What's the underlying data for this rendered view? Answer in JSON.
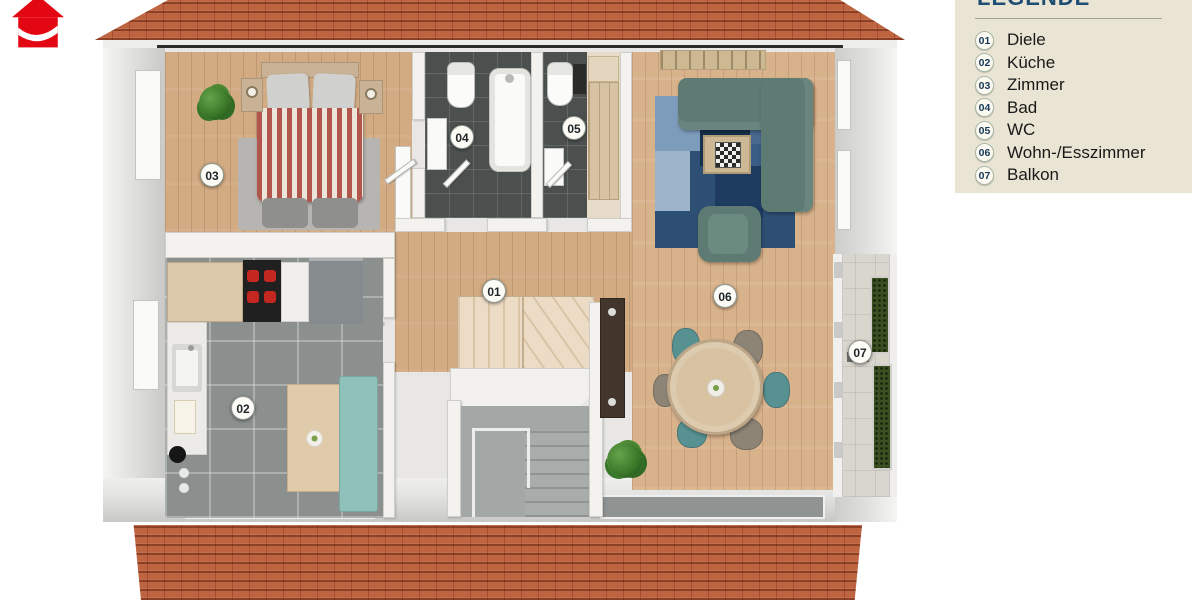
{
  "legend": {
    "title": "LEGENDE",
    "items": [
      {
        "num": "01",
        "label": "Diele"
      },
      {
        "num": "02",
        "label": "Küche"
      },
      {
        "num": "03",
        "label": "Zimmer"
      },
      {
        "num": "04",
        "label": "Bad"
      },
      {
        "num": "05",
        "label": "WC"
      },
      {
        "num": "06",
        "label": "Wohn-/Esszimmer"
      },
      {
        "num": "07",
        "label": "Balkon"
      }
    ]
  },
  "plan": {
    "badges": [
      {
        "num": "01"
      },
      {
        "num": "02"
      },
      {
        "num": "03"
      },
      {
        "num": "04"
      },
      {
        "num": "05"
      },
      {
        "num": "06"
      },
      {
        "num": "07"
      }
    ]
  },
  "icons": {
    "logo": "red-house-logo"
  },
  "colors": {
    "logo_red": "#e30613",
    "roof_tile": "#bf6440",
    "legend_bg": "#e9e4d3",
    "legend_title": "#1e4e74",
    "wood_floor": "#d5ae87",
    "kitchen_tile": "#8b908e",
    "bath_tile": "#4b504f",
    "sofa_teal": "#5d7b72",
    "rug_blue": "#2e4f74"
  }
}
